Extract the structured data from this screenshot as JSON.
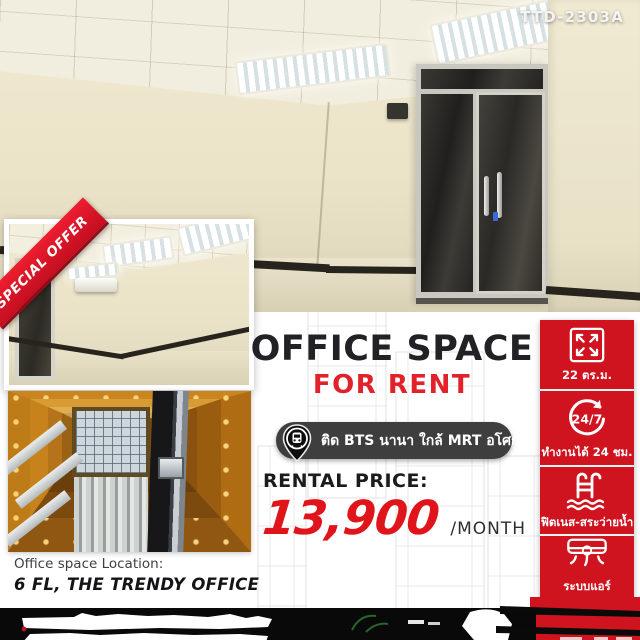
{
  "poster": {
    "ref_code": "TTD-2303A",
    "ribbon": "SPECIAL OFFER",
    "headline": "OFFICE SPACE",
    "subheadline": "FOR RENT",
    "transit_badge": "ติด BTS นานา ใกล้ MRT อโศก",
    "rental": {
      "label": "RENTAL PRICE:",
      "price": "13,900",
      "unit": "/MONTH"
    },
    "features": [
      {
        "icon": "expand-arrows-icon",
        "label": "22 ตร.ม."
      },
      {
        "icon": "24-7-clock-icon",
        "icon_text": "24/7",
        "label": "ทำงานได้ 24 ชม."
      },
      {
        "icon": "swimming-pool-icon",
        "label": "ฟิตเนส-สระว่ายน้ำ"
      },
      {
        "icon": "air-conditioner-icon",
        "label": "ระบบแอร์",
        "sublabel": "Split type"
      }
    ],
    "location": {
      "caption": "Office space Location:",
      "value": "6 FL, THE TRENDY OFFICE"
    },
    "colors": {
      "accent_red": "#cf1420",
      "price_red": "#e0151c",
      "ribbon_red": "#e11a2b",
      "badge_dark": "#3f3e3e",
      "text_dark": "#212126",
      "room_beige": "#ece4c8"
    }
  }
}
